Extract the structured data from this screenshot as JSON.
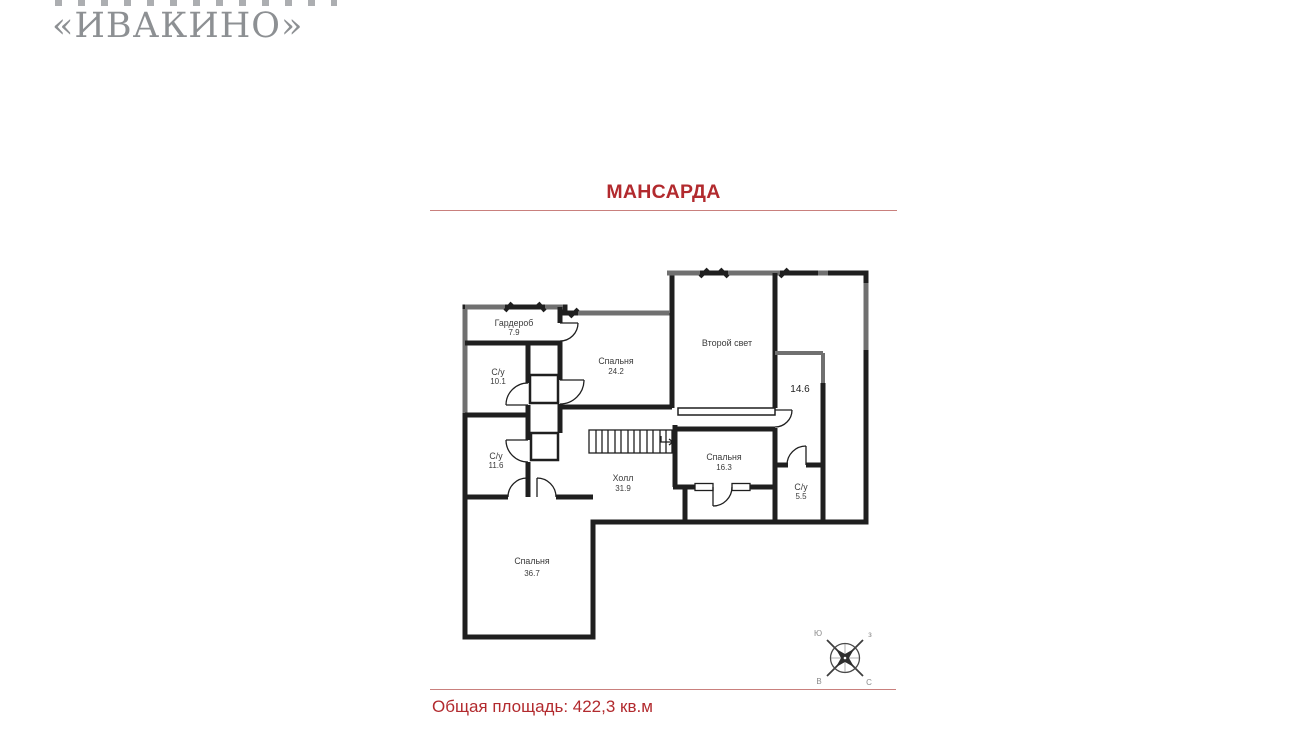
{
  "logo": {
    "name": "«ИВАКИНО»"
  },
  "title": "МАНСАРДА",
  "footer": {
    "total_area": "Общая площадь: 422,3 кв.м"
  },
  "colors": {
    "accent_red": "#b22a2e",
    "rule_red": "#c9807d",
    "logo_gray": "#8d9093",
    "wall_black": "#1f1f1f",
    "wall_gray": "#707070"
  },
  "rooms": [
    {
      "name": "Гардероб",
      "area": "7.9"
    },
    {
      "name": "С/у",
      "area": "10.1"
    },
    {
      "name": "Спальня",
      "area": "24.2"
    },
    {
      "name": "Второй свет",
      "area": ""
    },
    {
      "name": "",
      "area": "14.6"
    },
    {
      "name": "С/у",
      "area": "11.6"
    },
    {
      "name": "Холл",
      "area": "31.9"
    },
    {
      "name": "Спальня",
      "area": "16.3"
    },
    {
      "name": "С/у",
      "area": "5.5"
    },
    {
      "name": "Спальня",
      "area": "36.7"
    }
  ],
  "compass": {
    "top_left": "Ю",
    "top_right": "з",
    "bottom_left": "В",
    "bottom_right": "С"
  }
}
